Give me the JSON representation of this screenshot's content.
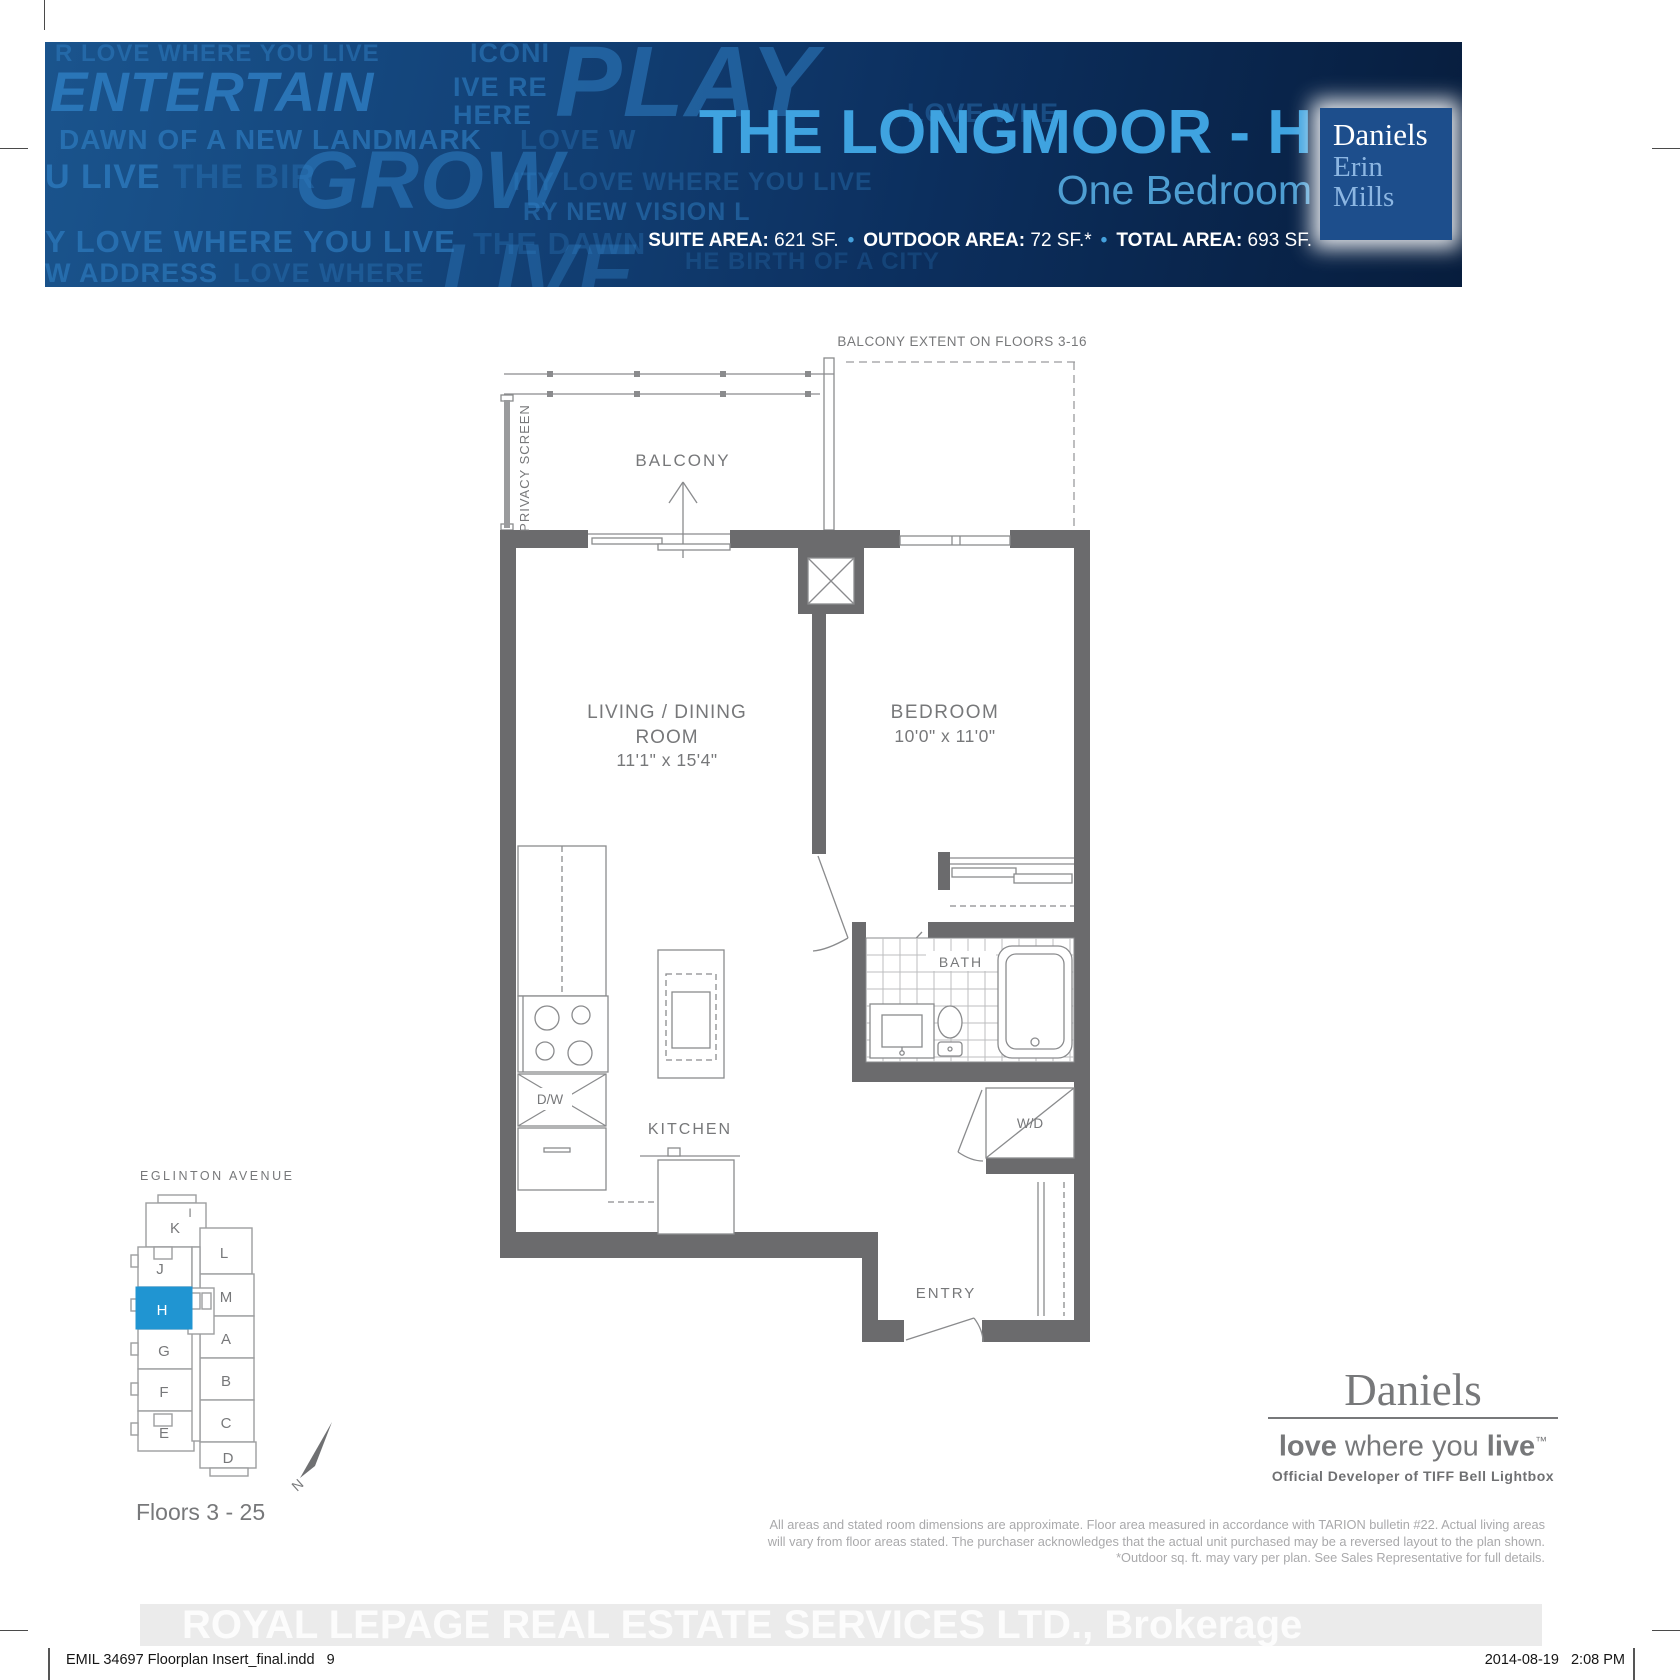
{
  "banner": {
    "title": "THE LONGMOOR - H",
    "subtitle": "One Bedroom",
    "stats": [
      {
        "label": "SUITE AREA:",
        "value": " 621 SF."
      },
      {
        "label": "OUTDOOR AREA:",
        "value": " 72 SF.*"
      },
      {
        "label": "TOTAL AREA:",
        "value": " 693 SF."
      }
    ],
    "separator": "•",
    "logo_box": {
      "line1": "Daniels",
      "line2": "Erin",
      "line3": "Mills"
    },
    "colors": {
      "title_blue": "#3fa3e0",
      "logo_box_blue": "#1d4e8c",
      "banner_navy": "#0c2f5e"
    },
    "watermark_words": [
      {
        "text": "R LOVE WHERE YOU LIVE",
        "x": 10,
        "y": 0,
        "size": 24,
        "o": 0.5
      },
      {
        "text": "ICONI",
        "x": 425,
        "y": -2,
        "size": 27,
        "o": 0.55
      },
      {
        "text": "ENTERTAIN",
        "x": 5,
        "y": 22,
        "size": 56,
        "o": 0.8,
        "i": true
      },
      {
        "text": "IVE RE",
        "x": 408,
        "y": 32,
        "size": 27,
        "o": 0.6
      },
      {
        "text": "HERE",
        "x": 408,
        "y": 60,
        "size": 27,
        "o": 0.6
      },
      {
        "text": "PLAY",
        "x": 510,
        "y": -10,
        "size": 100,
        "o": 0.55,
        "i": true
      },
      {
        "text": "LOVE WHE",
        "x": 862,
        "y": 58,
        "size": 27,
        "o": 0.4
      },
      {
        "text": "DAWN OF A NEW LANDMARK",
        "x": 14,
        "y": 84,
        "size": 28,
        "o": 0.65
      },
      {
        "text": "LOVE W",
        "x": 475,
        "y": 84,
        "size": 28,
        "o": 0.35
      },
      {
        "text": "U LIVE",
        "x": 0,
        "y": 118,
        "size": 34,
        "o": 0.7
      },
      {
        "text": "THE BIR",
        "x": 128,
        "y": 118,
        "size": 34,
        "o": 0.35
      },
      {
        "text": "GROW",
        "x": 250,
        "y": 98,
        "size": 82,
        "o": 0.55,
        "i": true
      },
      {
        "text": "ITY LOVE WHERE YOU LIVE",
        "x": 468,
        "y": 128,
        "size": 25,
        "o": 0.35
      },
      {
        "text": "RY NEW VISION L",
        "x": 478,
        "y": 158,
        "size": 25,
        "o": 0.5
      },
      {
        "text": "Y LOVE WHERE YOU LIVE",
        "x": 0,
        "y": 184,
        "size": 31,
        "o": 0.65
      },
      {
        "text": "THE DAWN",
        "x": 428,
        "y": 186,
        "size": 31,
        "o": 0.3
      },
      {
        "text": "W ADDRESS",
        "x": 0,
        "y": 218,
        "size": 27,
        "o": 0.6
      },
      {
        "text": "LOVE WHERE",
        "x": 188,
        "y": 218,
        "size": 27,
        "o": 0.35
      },
      {
        "text": "LIVE",
        "x": 395,
        "y": 190,
        "size": 86,
        "o": 0.4,
        "i": true
      },
      {
        "text": "HE BIRTH OF A CITY",
        "x": 640,
        "y": 208,
        "size": 24,
        "o": 0.25
      }
    ]
  },
  "plan": {
    "balcony_extent_note": "BALCONY EXTENT ON FLOORS 3-16",
    "privacy_screen": "PRIVACY SCREEN",
    "balcony": "BALCONY",
    "living_name_1": "LIVING / DINING",
    "living_name_2": "ROOM",
    "living_dims": "11'1\" x 15'4\"",
    "bedroom_name": "BEDROOM",
    "bedroom_dims": "10'0\" x 11'0\"",
    "bath": "BATH",
    "kitchen": "KITCHEN",
    "entry": "ENTRY",
    "washer_dryer": "W/D",
    "dishwasher": "D/W"
  },
  "keyplan": {
    "street": "EGLINTON AVENUE",
    "floors_note": "Floors 3 - 25",
    "compass": "N",
    "highlighted_unit": "H",
    "highlight_color": "#2095d2",
    "units": [
      {
        "label": "K"
      },
      {
        "label": "I"
      },
      {
        "label": "J"
      },
      {
        "label": "L"
      },
      {
        "label": "H"
      },
      {
        "label": "M"
      },
      {
        "label": "G"
      },
      {
        "label": "A"
      },
      {
        "label": "F"
      },
      {
        "label": "B"
      },
      {
        "label": "E"
      },
      {
        "label": "C"
      },
      {
        "label": "D"
      }
    ]
  },
  "footer": {
    "brand": "Daniels",
    "tagline": {
      "bold1": "love",
      "mid": " where you ",
      "bold2": "live",
      "tm": "™"
    },
    "developer_line": "Official Developer of TIFF Bell Lightbox",
    "disclaimer_lines": [
      "All areas and stated room dimensions are approximate. Floor area measured in accordance with TARION bulletin #22. Actual living areas",
      "will vary from floor areas stated. The purchaser acknowledges that the actual unit purchased may be a reversed layout to the plan shown.",
      "*Outdoor sq. ft. may vary per plan. See Sales Representative for full details."
    ],
    "brokerage_watermark": "ROYAL LEPAGE REAL ESTATE SERVICES LTD.,  Brokerage",
    "file_note": "EMIL 34697 Floorplan Insert_final.indd   9",
    "datetime": "2014-08-19   2:08 PM"
  }
}
